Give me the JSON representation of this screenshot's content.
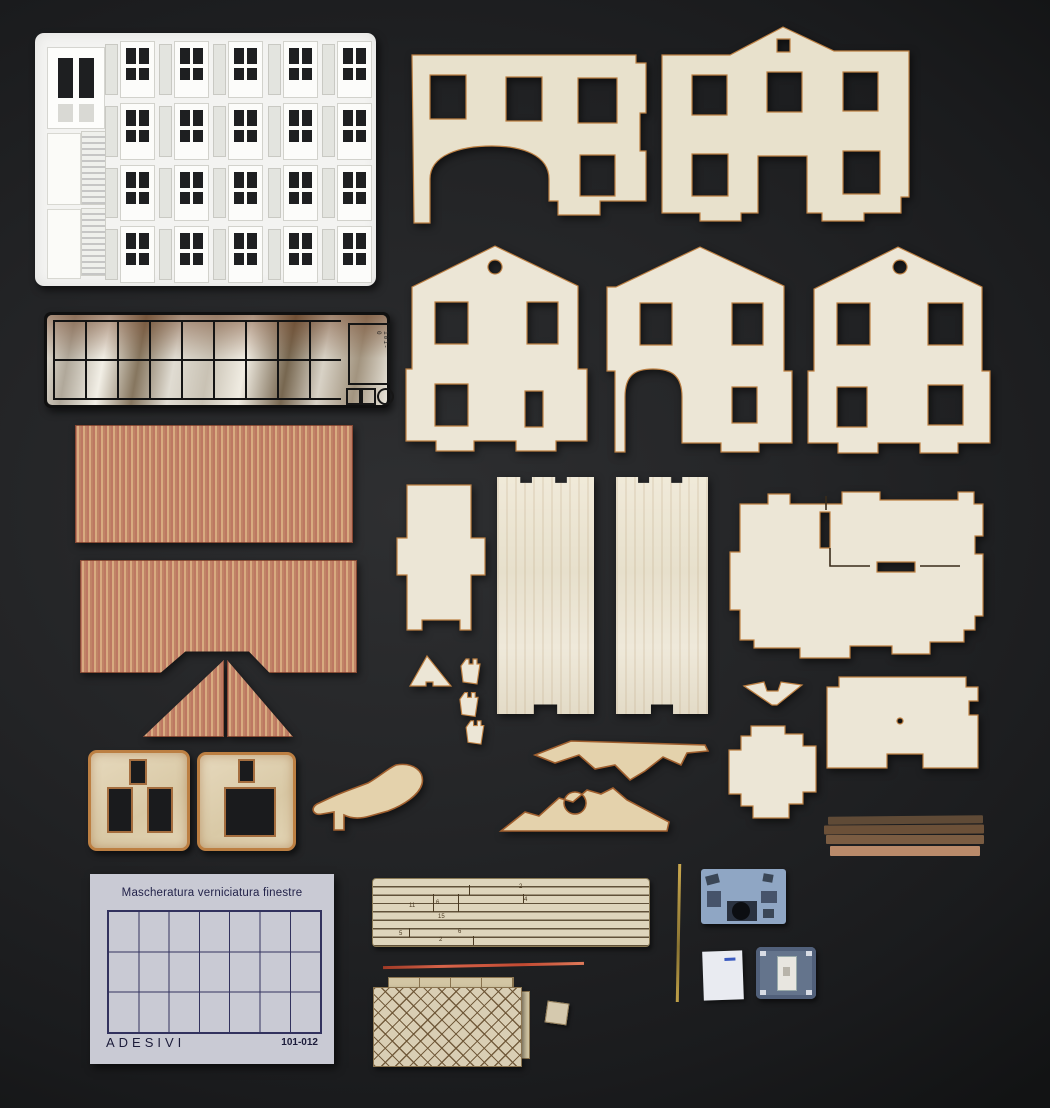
{
  "palette": {
    "background_dark": "#1a1b1d",
    "background_light": "#2e2f31",
    "plywood": "#ece6d6",
    "plywood_warm": "#e8e1cc",
    "burn_edge": "#bc7f42",
    "tile_red": "#bd7862",
    "tile_gap": "#d8ab80",
    "etch_white": "#f3f3f1",
    "pane_dark": "#1e1f21",
    "paper": "#c9cad4",
    "paper_ink": "#23234a",
    "strip_sheet": "#ded5bc",
    "lattice": "#d9ceb4",
    "film_blue": "#8fa6c4",
    "decal_white": "#e9ebf1",
    "part_blue": "#64748c"
  },
  "labels": {
    "masking_sheet_title": "Mascheratura verniciatura finestre",
    "masking_sheet_footer_left": "ADESIVI",
    "masking_sheet_footer_right": "101-012",
    "glazing_code": "101-0",
    "strip_numbers": [
      "2",
      "4",
      "11",
      "6",
      "15",
      "5",
      "6",
      "2"
    ]
  }
}
